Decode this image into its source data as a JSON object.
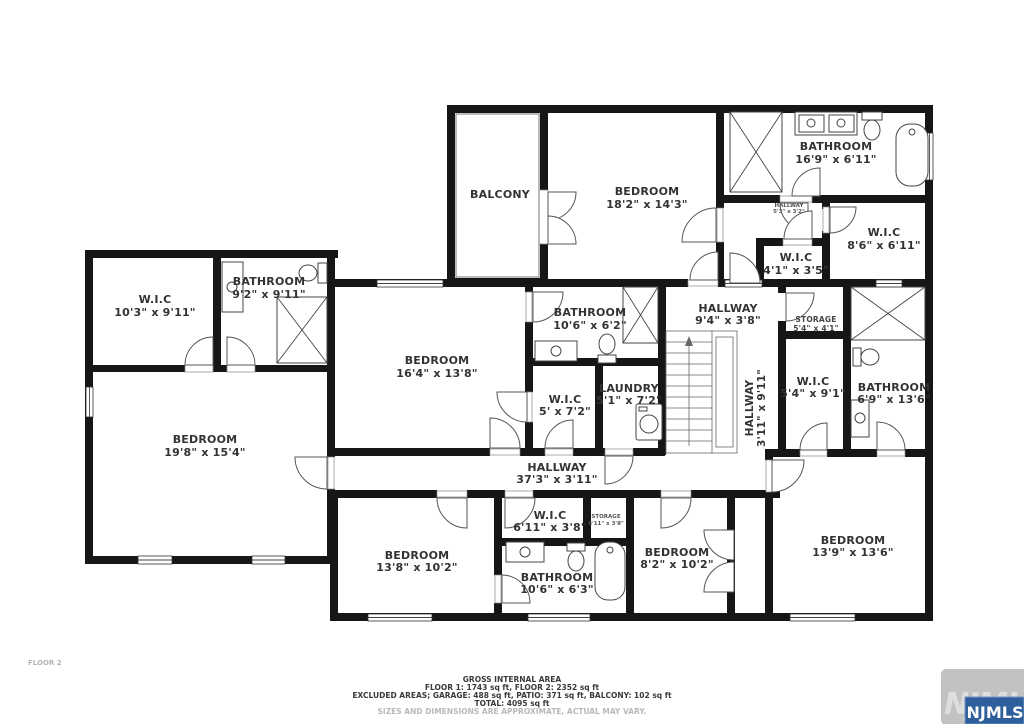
{
  "floor_label": "FLOOR 2",
  "rooms": [
    {
      "name": "BALCONY",
      "dims": ""
    },
    {
      "name": "BEDROOM",
      "dims": "18'2\" x 14'3\""
    },
    {
      "name": "BATHROOM",
      "dims": "16'9\" x 6'11\""
    },
    {
      "name": "HALLWAY",
      "dims": "5'3\" x 3'2\""
    },
    {
      "name": "W.I.C",
      "dims": "8'6\" x 6'11\""
    },
    {
      "name": "W.I.C",
      "dims": "4'1\" x 3'5\""
    },
    {
      "name": "W.I.C",
      "dims": "10'3\" x 9'11\""
    },
    {
      "name": "BATHROOM",
      "dims": "9'2\" x 9'11\""
    },
    {
      "name": "BEDROOM",
      "dims": "19'8\" x 15'4\""
    },
    {
      "name": "BEDROOM",
      "dims": "16'4\" x 13'8\""
    },
    {
      "name": "BATHROOM",
      "dims": "10'6\" x 6'2\""
    },
    {
      "name": "W.I.C",
      "dims": "5' x 7'2\""
    },
    {
      "name": "LAUNDRY",
      "dims": "5'1\" x 7'2\""
    },
    {
      "name": "HALLWAY",
      "dims": "9'4\" x 3'8\""
    },
    {
      "name": "STORAGE",
      "dims": "5'4\" x 4'1\""
    },
    {
      "name": "HALLWAY",
      "dims": "3'11\" x 9'11\""
    },
    {
      "name": "W.I.C",
      "dims": "5'4\" x 9'1\""
    },
    {
      "name": "BATHROOM",
      "dims": "6'9\" x 13'6\""
    },
    {
      "name": "HALLWAY",
      "dims": "37'3\" x 3'11\""
    },
    {
      "name": "W.I.C",
      "dims": "6'11\" x 3'8\""
    },
    {
      "name": "STORAGE",
      "dims": "6'11\" x 3'8\""
    },
    {
      "name": "BEDROOM",
      "dims": "13'8\" x 10'2\""
    },
    {
      "name": "BATHROOM",
      "dims": "10'6\" x 6'3\""
    },
    {
      "name": "BEDROOM",
      "dims": "8'2\" x 10'2\""
    },
    {
      "name": "BEDROOM",
      "dims": "13'9\" x 13'6\""
    }
  ],
  "footer": {
    "line1": "GROSS INTERNAL AREA",
    "line2": "FLOOR 1: 1743 sq ft, FLOOR 2: 2352 sq ft",
    "line3": "EXCLUDED AREAS; GARAGE: 488 sq ft, PATIO: 371 sq ft, BALCONY: 102 sq ft",
    "line4": "TOTAL: 4095 sq ft",
    "disclaimer": "SIZES AND DIMENSIONS ARE APPROXIMATE, ACTUAL MAY VARY."
  },
  "watermark_text": "NJMLS",
  "logo_text": "NJMLS",
  "colors": {
    "walls": "#161616",
    "logo_blue": "#2e5f9c",
    "logo_gray": "#c2c2c2",
    "label_text": "#333333"
  }
}
